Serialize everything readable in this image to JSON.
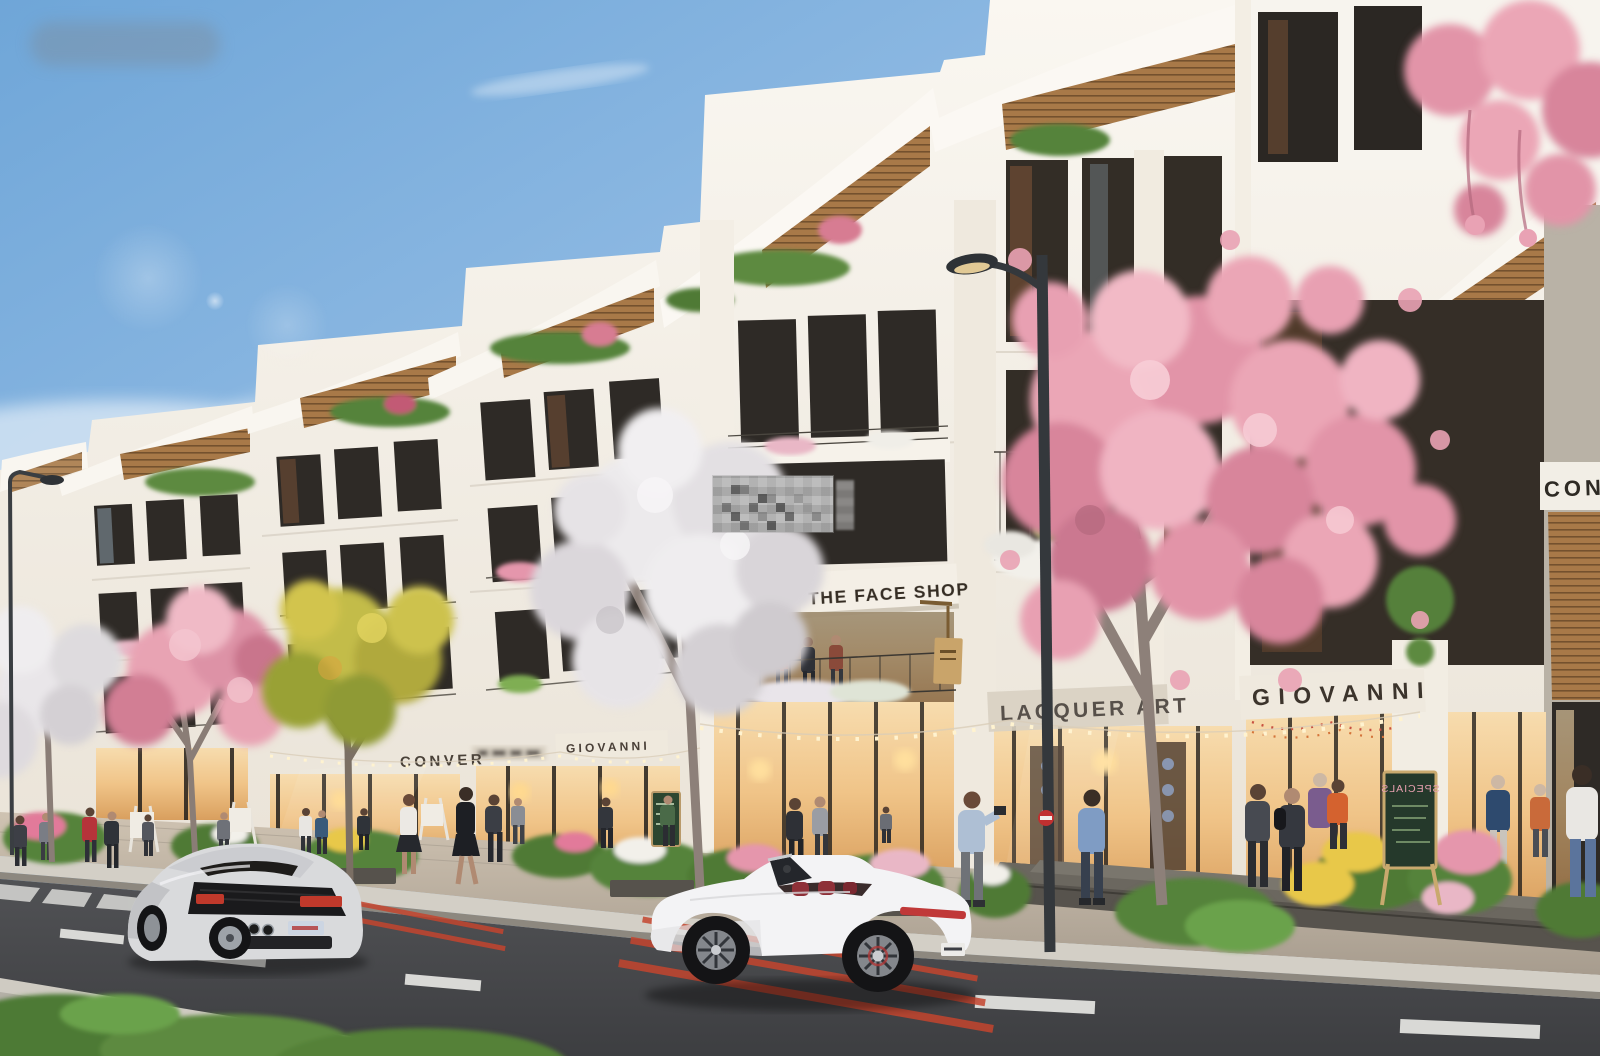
{
  "scene": {
    "type": "architectural-render",
    "subject": "shophouse street with blossom trees, pedestrians and two sports cars",
    "watermarks": {
      "top_left": "blurred-smudge",
      "center": "pixelated-block"
    },
    "vehicles": {
      "left": "silver sports coupe (rear view)",
      "center": "white convertible (side view)"
    }
  },
  "signs": {
    "face_shop": "THE FACE SHOP",
    "lacquer_art": "LACQUER ART",
    "giovanni_right": "GIOVANNI",
    "giovanni_left": "GIOVANNI",
    "converse_partial": "CONVER",
    "corner_partial": "CON",
    "chalkboard": "SPECIALS"
  },
  "colors": {
    "sky_top": "#6FA6D8",
    "sky_horizon": "#DCE9F3",
    "facade_white": "#F5F1EA",
    "roof_wood": "#A87948",
    "window_dark": "#2E2A26",
    "storefront_glow": "#F3CE96",
    "blossom_pink": "#E89CAE",
    "blossom_white": "#EDEBED",
    "foliage_yellow": "#BFB945",
    "foliage_green": "#5D8A3F",
    "asphalt": "#47484B",
    "curb": "#D3CFC6",
    "lane_red": "#C4452F",
    "lane_white": "#D9D9D6",
    "lamp_gray": "#34383C",
    "car_silver": "#D9DADC",
    "car_white": "#F3F3F5",
    "seat_red": "#8E3038"
  }
}
